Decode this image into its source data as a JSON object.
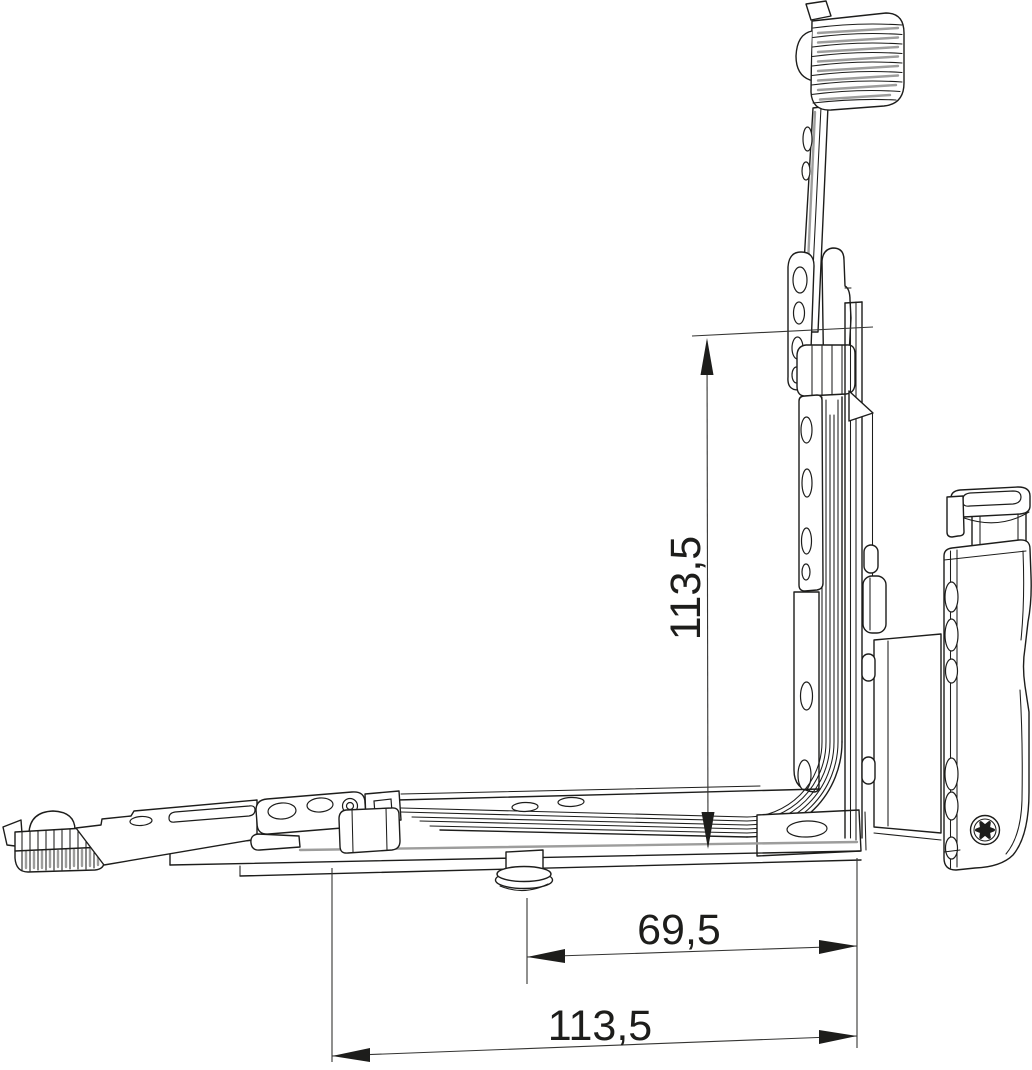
{
  "drawing": {
    "title": "corner-hinge-assembly-technical-drawing",
    "background": "#ffffff",
    "line_color": "#1d1d1b",
    "shade_color": "#9d9d9c",
    "parts": [
      "toothed-slider-block-top",
      "tilt-arm",
      "tilt-arm-pivot-plates",
      "vertical-faceplate",
      "corner-guide-band",
      "horizontal-faceplate",
      "toothed-slider-block-left",
      "locking-arm",
      "arm-pivot-plate",
      "rail-clamp",
      "mushroom-cam-pin",
      "corner-hinge-plate",
      "frame-hinge-body",
      "pivot-cap",
      "torx-screw"
    ]
  },
  "dimensions": {
    "vertical": {
      "value": "113,5"
    },
    "horizontal_inner": {
      "value": "69,5"
    },
    "horizontal_outer": {
      "value": "113,5"
    }
  }
}
